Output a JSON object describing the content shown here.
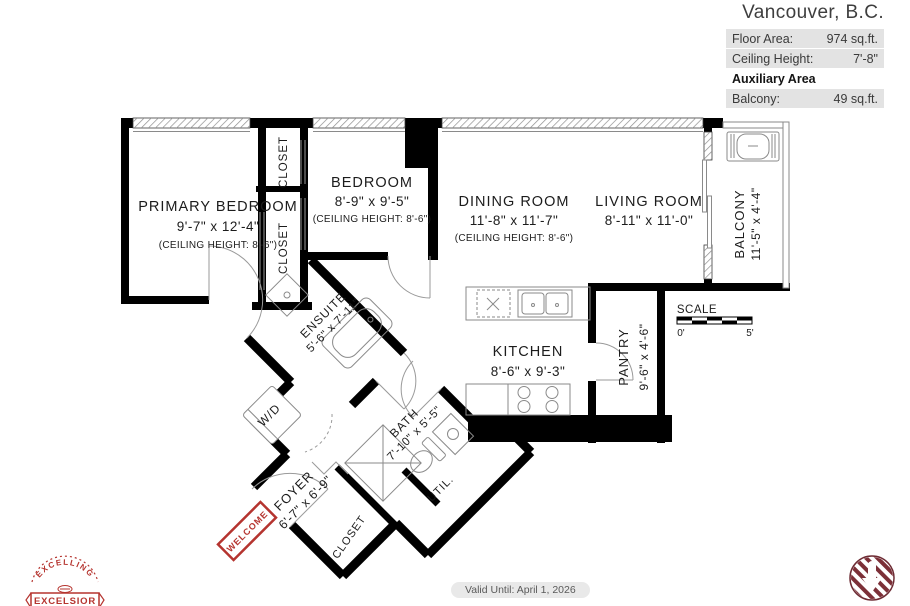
{
  "header": {
    "title": "Vancouver, B.C.",
    "rows": [
      {
        "label": "Floor Area:",
        "value": "974 sq.ft."
      },
      {
        "label": "Ceiling Height:",
        "value": "7'-8\""
      },
      {
        "label": "Auxiliary Area",
        "value": ""
      },
      {
        "label": "Balcony:",
        "value": "49 sq.ft."
      }
    ]
  },
  "rooms": {
    "primary_bedroom": {
      "name": "PRIMARY BEDROOM",
      "dims": "9'-7\"  x  12'-4\"",
      "ceiling": "(CEILING HEIGHT: 8'-6\")"
    },
    "bedroom": {
      "name": "BEDROOM",
      "dims": "8'-9\"  x  9'-5\"",
      "ceiling": "(CEILING HEIGHT: 8'-6\")"
    },
    "dining_room": {
      "name": "DINING ROOM",
      "dims": "11'-8\"  x  11'-7\"",
      "ceiling": "(CEILING HEIGHT: 8'-6\")"
    },
    "living_room": {
      "name": "LIVING ROOM",
      "dims": "8'-11\"  x  11'-0\""
    },
    "balcony": {
      "name": "BALCONY",
      "dims": "11'-5\" x 4'-4\""
    },
    "kitchen": {
      "name": "KITCHEN",
      "dims": "8'-6\"  x  9'-3\""
    },
    "pantry": {
      "name": "PANTRY",
      "dims": "9'-6\" x 4'-6\""
    },
    "ensuite": {
      "name": "ENSUITE",
      "dims": "5'-6\" x 7'-11\""
    },
    "bath": {
      "name": "BATH",
      "dims": "7'-10\" x 5'-5\""
    },
    "foyer": {
      "name": "FOYER",
      "dims": "6'-7\" x 6'-9\""
    },
    "closet_top": "CLOSET",
    "closet_mid": "CLOSET",
    "closet_entry": "CLOSET",
    "util": "UTIL.",
    "wd": "W/D",
    "welcome_mat": "WELCOME"
  },
  "scale_bar": {
    "label": "SCALE",
    "start": "0'",
    "end": "5'"
  },
  "footer": {
    "valid_until": "Valid Until: April 1, 2026"
  },
  "logos": {
    "left": {
      "arc_text": "EXCELLING",
      "banner_text": "EXCELSIOR"
    }
  },
  "colors": {
    "wall": "#000000",
    "thin_line": "#8a8a8a",
    "accent_red": "#b5342f",
    "logo_maroon": "#7c3038",
    "table_row_bg": "#e3e3e3"
  }
}
